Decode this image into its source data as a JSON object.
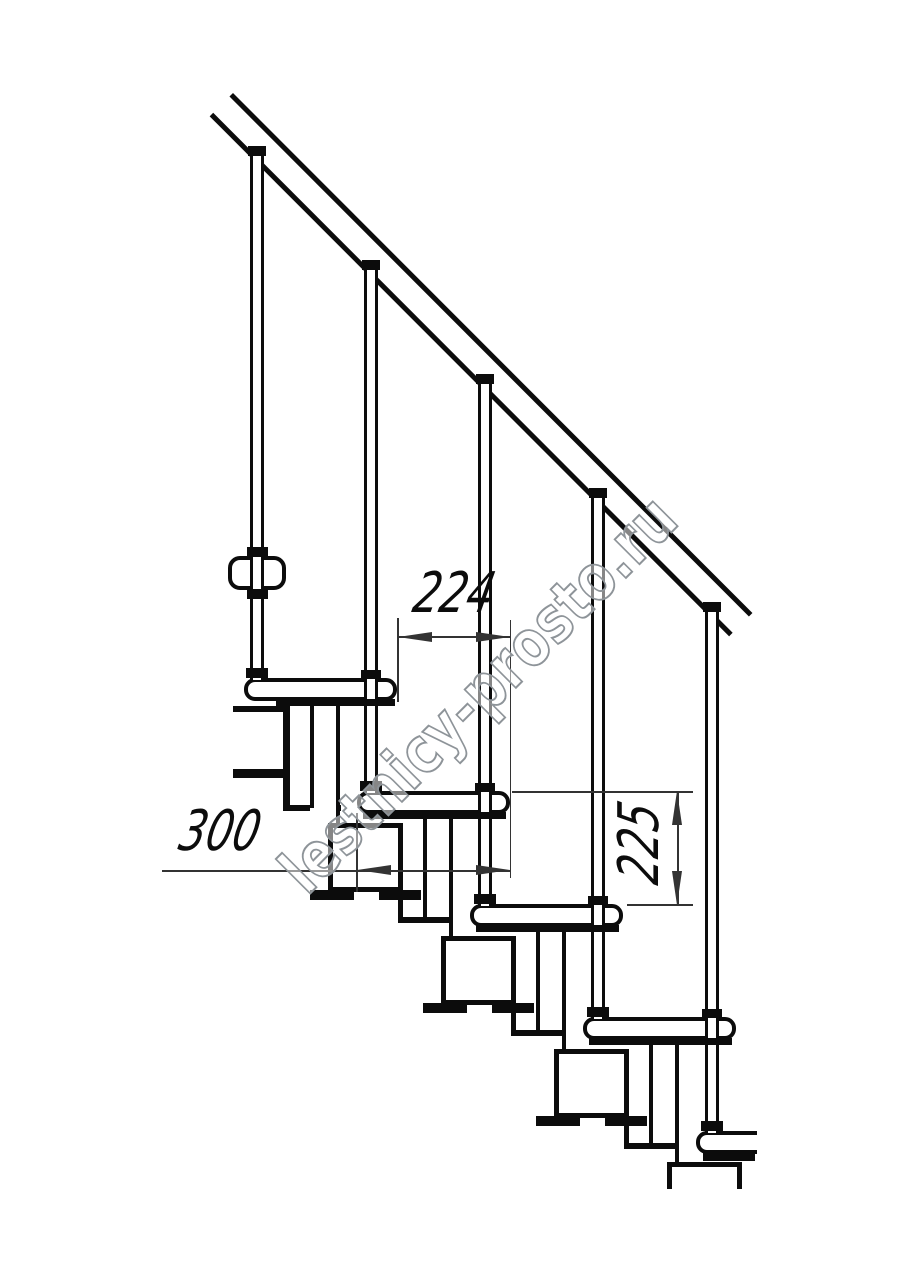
{
  "drawing": {
    "kind": "modular-staircase-side-elevation",
    "units": "mm",
    "dimensions": {
      "step_run": "224",
      "tread_depth": "300",
      "riser_height": "225"
    },
    "structure": {
      "balusters": 5,
      "treads": 5,
      "stringer_modules": 4,
      "handrail": 1
    },
    "watermark": {
      "text": "lestnicy-prosto.ru"
    },
    "colors": {
      "line": "#0c0c0c",
      "dimension_line": "#333333",
      "background": "#ffffff",
      "watermark_stroke": "#8e9499"
    }
  }
}
